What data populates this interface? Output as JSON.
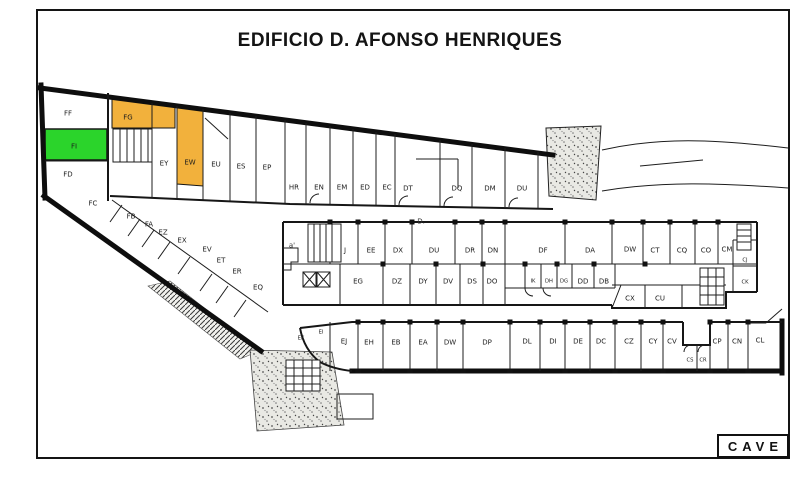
{
  "title": "EDIFICIO D. AFONSO HENRIQUES",
  "level_badge": "CAVE",
  "colors": {
    "highlight_green": "#2bd42b",
    "highlight_orange": "#f2b13c",
    "wall": "#141414"
  },
  "highlighted_units": {
    "green": [
      "FI"
    ],
    "orange": [
      "FG",
      "EW"
    ]
  },
  "annotations": [
    {
      "text": "D.",
      "x": 421,
      "y": 221
    },
    {
      "text": "a'",
      "x": 292,
      "y": 245
    }
  ],
  "plan": {
    "units": [
      {
        "label": "FF",
        "x": 68,
        "y": 113
      },
      {
        "label": "FG",
        "x": 128,
        "y": 117,
        "highlight": "orange"
      },
      {
        "label": "FI",
        "x": 74,
        "y": 146,
        "highlight": "green"
      },
      {
        "label": "FD",
        "x": 68,
        "y": 174
      },
      {
        "label": "EY",
        "x": 164,
        "y": 163
      },
      {
        "label": "EW",
        "x": 190,
        "y": 162,
        "highlight": "orange"
      },
      {
        "label": "EU",
        "x": 216,
        "y": 164
      },
      {
        "label": "ES",
        "x": 241,
        "y": 166
      },
      {
        "label": "EP",
        "x": 267,
        "y": 167
      },
      {
        "label": "HR",
        "x": 294,
        "y": 187
      },
      {
        "label": "EN",
        "x": 319,
        "y": 187
      },
      {
        "label": "EM",
        "x": 342,
        "y": 187
      },
      {
        "label": "ED",
        "x": 365,
        "y": 187
      },
      {
        "label": "EC",
        "x": 387,
        "y": 187
      },
      {
        "label": "DT",
        "x": 408,
        "y": 188
      },
      {
        "label": "DQ",
        "x": 457,
        "y": 188
      },
      {
        "label": "DM",
        "x": 490,
        "y": 188
      },
      {
        "label": "DU",
        "x": 522,
        "y": 188
      },
      {
        "label": "FC",
        "x": 93,
        "y": 203
      },
      {
        "label": "FB",
        "x": 131,
        "y": 216
      },
      {
        "label": "FA",
        "x": 149,
        "y": 224
      },
      {
        "label": "EZ",
        "x": 163,
        "y": 232
      },
      {
        "label": "EX",
        "x": 182,
        "y": 240
      },
      {
        "label": "EV",
        "x": 207,
        "y": 249
      },
      {
        "label": "ET",
        "x": 221,
        "y": 260
      },
      {
        "label": "ER",
        "x": 237,
        "y": 271
      },
      {
        "label": "EQ",
        "x": 258,
        "y": 287
      },
      {
        "label": "J",
        "x": 345,
        "y": 250
      },
      {
        "label": "EE",
        "x": 371,
        "y": 250
      },
      {
        "label": "DX",
        "x": 398,
        "y": 250
      },
      {
        "label": "DU",
        "x": 434,
        "y": 250
      },
      {
        "label": "DR",
        "x": 470,
        "y": 250
      },
      {
        "label": "DN",
        "x": 493,
        "y": 250
      },
      {
        "label": "DF",
        "x": 543,
        "y": 250
      },
      {
        "label": "DA",
        "x": 590,
        "y": 250
      },
      {
        "label": "DW",
        "x": 630,
        "y": 249
      },
      {
        "label": "CT",
        "x": 655,
        "y": 250
      },
      {
        "label": "CQ",
        "x": 682,
        "y": 250
      },
      {
        "label": "CO",
        "x": 706,
        "y": 250
      },
      {
        "label": "CM",
        "x": 727,
        "y": 249
      },
      {
        "label": "CJ",
        "x": 745,
        "y": 259,
        "small": true
      },
      {
        "label": "CK",
        "x": 745,
        "y": 281,
        "small": true
      },
      {
        "label": "EG",
        "x": 358,
        "y": 281
      },
      {
        "label": "DZ",
        "x": 397,
        "y": 281
      },
      {
        "label": "DY",
        "x": 423,
        "y": 281
      },
      {
        "label": "DV",
        "x": 448,
        "y": 281
      },
      {
        "label": "DS",
        "x": 472,
        "y": 281
      },
      {
        "label": "DO",
        "x": 492,
        "y": 281
      },
      {
        "label": "IK",
        "x": 533,
        "y": 280,
        "small": true
      },
      {
        "label": "DH",
        "x": 549,
        "y": 280,
        "small": true
      },
      {
        "label": "DG",
        "x": 564,
        "y": 280,
        "small": true
      },
      {
        "label": "DD",
        "x": 583,
        "y": 281
      },
      {
        "label": "DB",
        "x": 604,
        "y": 281
      },
      {
        "label": "CX",
        "x": 630,
        "y": 298
      },
      {
        "label": "CU",
        "x": 660,
        "y": 298
      },
      {
        "label": "EK",
        "x": 301,
        "y": 337,
        "small": true
      },
      {
        "label": "EI",
        "x": 321,
        "y": 331,
        "small": true
      },
      {
        "label": "EJ",
        "x": 344,
        "y": 341
      },
      {
        "label": "EH",
        "x": 369,
        "y": 342
      },
      {
        "label": "EB",
        "x": 396,
        "y": 342
      },
      {
        "label": "EA",
        "x": 423,
        "y": 342
      },
      {
        "label": "DW",
        "x": 450,
        "y": 342
      },
      {
        "label": "DP",
        "x": 487,
        "y": 342
      },
      {
        "label": "DL",
        "x": 527,
        "y": 341
      },
      {
        "label": "DI",
        "x": 553,
        "y": 341
      },
      {
        "label": "DE",
        "x": 578,
        "y": 341
      },
      {
        "label": "DC",
        "x": 601,
        "y": 341
      },
      {
        "label": "CZ",
        "x": 629,
        "y": 341
      },
      {
        "label": "CY",
        "x": 653,
        "y": 341
      },
      {
        "label": "CV",
        "x": 672,
        "y": 341
      },
      {
        "label": "CS",
        "x": 690,
        "y": 359,
        "small": true
      },
      {
        "label": "CR",
        "x": 703,
        "y": 359,
        "small": true
      },
      {
        "label": "CP",
        "x": 717,
        "y": 341
      },
      {
        "label": "CN",
        "x": 737,
        "y": 341
      },
      {
        "label": "CL",
        "x": 760,
        "y": 340
      }
    ]
  }
}
